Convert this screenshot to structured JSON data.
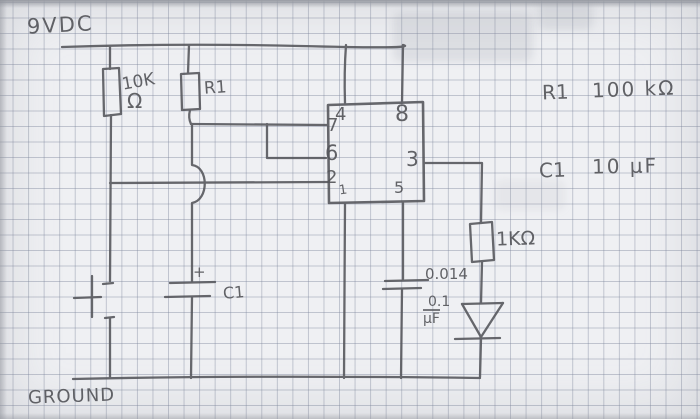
{
  "rails": {
    "supply_label": "9VDC",
    "ground_label": "GROUND"
  },
  "components": {
    "pullup_resistor": {
      "value": "10K",
      "unit": "Ω"
    },
    "timing_resistor": {
      "name": "R1"
    },
    "timing_capacitor": {
      "name": "C1",
      "polarity_mark": "+"
    },
    "output_resistor": {
      "value": "1KΩ"
    },
    "control_capacitor": {
      "value_line1": "0.014",
      "value_line2": "0.1",
      "value_line3": "μF"
    }
  },
  "ic": {
    "pins": {
      "pin4": "4",
      "pin8": "8",
      "pin7": "7",
      "pin6": "6",
      "pin2": "2",
      "pin1": "1",
      "pin3": "3",
      "pin5": "5"
    }
  },
  "notes": {
    "r1_name": "R1",
    "r1_value": "100 kΩ",
    "c1_name": "C1",
    "c1_value": "10 μF"
  },
  "colors": {
    "pencil": "#54555a",
    "paper": "#eff0f3",
    "grid_line": "#7d869c"
  }
}
